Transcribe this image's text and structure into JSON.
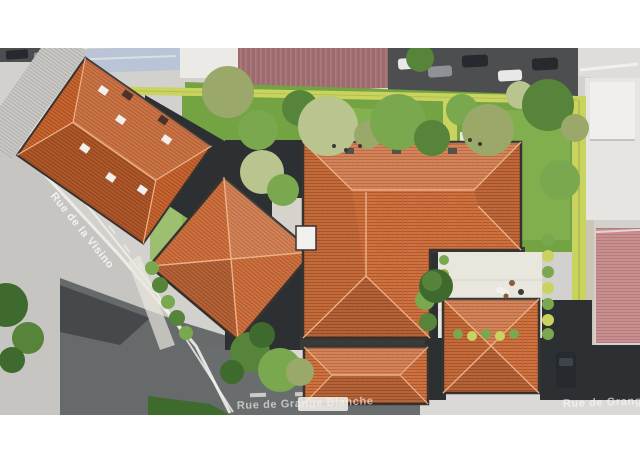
{
  "labels": {
    "street_left": "Rue de la Visino",
    "street_bottom_center": "Rue de Grange Blanche",
    "street_bottom_right": "Rue de Grange Bl"
  },
  "colors": {
    "background": "#ffffff",
    "street": "#d2d1ce",
    "street_light": "#deddda",
    "street_dark": "#c6c5c2",
    "asphalt_dark": "#56595b",
    "asphalt_deep": "#46494c",
    "curb_white": "#efeeea",
    "marking_white": "#f4f3ef",
    "roof_orange": "#ce7342",
    "roof_orange_dark": "#b05628",
    "roof_orange_mid": "#c3683a",
    "roof_ridge": "#ecb287",
    "roof_eave": "#3a3430",
    "existing_roof": "#c86531",
    "existing_roof_dark": "#a44e20",
    "grey_roof": "#b7b6b3",
    "grey_roof_light": "#cfcecb",
    "flat_roof_dark": "#2d3032",
    "shadow_dark": "#3a3a38",
    "lawn": "#73a342",
    "lawn_light": "#8fbb58",
    "hedge": "#c9d35f",
    "hedge_dark": "#9fae3f",
    "tree_green": "#55843a",
    "tree_green_light": "#79a84e",
    "tree_olive": "#9aa96a",
    "tree_pale": "#b9c48e",
    "tree_dark": "#3f6a2e",
    "terrace": "#e9e6de",
    "terrace_line": "#d8d4c8",
    "maroon_roof": "#9c6b6e",
    "maroon_roof_light": "#ad7a7e",
    "blue_roof": "#b9c5d6",
    "white_gap": "#eceae7",
    "pink_roof": "#c98f90",
    "pink_roof_line": "#b57c7d",
    "neighbor_white": "#e6e5e1",
    "neighbor_roof_white": "#f0efec",
    "beige_wall": "#cec6b4",
    "parking_dark": "#4c4e50",
    "car_dark": "#26292d",
    "car_white": "#e8e8e8",
    "car_grey": "#8e9296",
    "car_glass": "#3e444c",
    "chimney_white": "#f2f0ec",
    "chimney_dark": "#4a3328",
    "roof_window": "#55504a",
    "people_brown": "#8a5a3a",
    "people_dark": "#3a3a3a",
    "label_text": "#ffffff"
  }
}
